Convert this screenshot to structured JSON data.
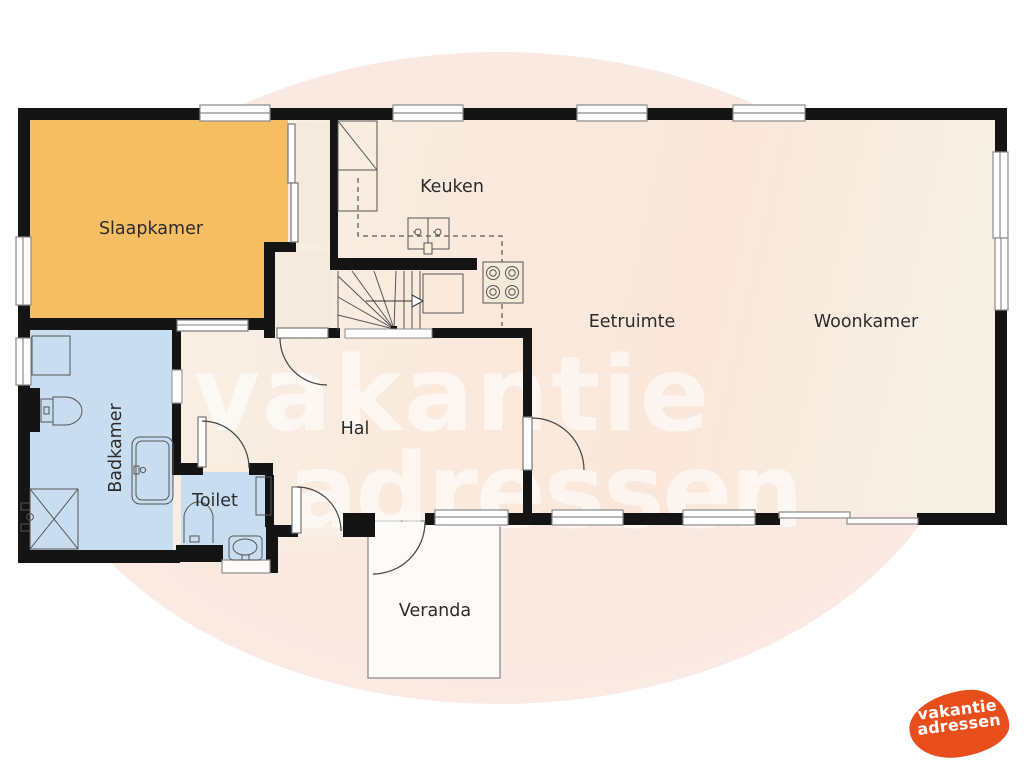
{
  "plan": {
    "labels": {
      "slaapkamer": "Slaapkamer",
      "keuken": "Keuken",
      "eetruimte": "Eetruimte",
      "woonkamer": "Woonkamer",
      "hal": "Hal",
      "badkamer": "Badkamer",
      "toilet": "Toilet",
      "veranda": "Veranda"
    },
    "watermark": {
      "line1": "vakantie",
      "line2": "adressen"
    },
    "logo": {
      "line1": "vakantie",
      "line2": "adressen"
    },
    "colors": {
      "bedroom_fill": "#f6be63",
      "bathroom_fill": "#c9ddf0",
      "floor_fill": "#f8eee2",
      "floor_tint": "#fae7d9",
      "wall": "#141414",
      "background_blob": "#fae9e1",
      "veranda_fill": "#fdfaf8",
      "logo_orange": "#e84e1b",
      "label_text": "#2b2b2b"
    }
  }
}
